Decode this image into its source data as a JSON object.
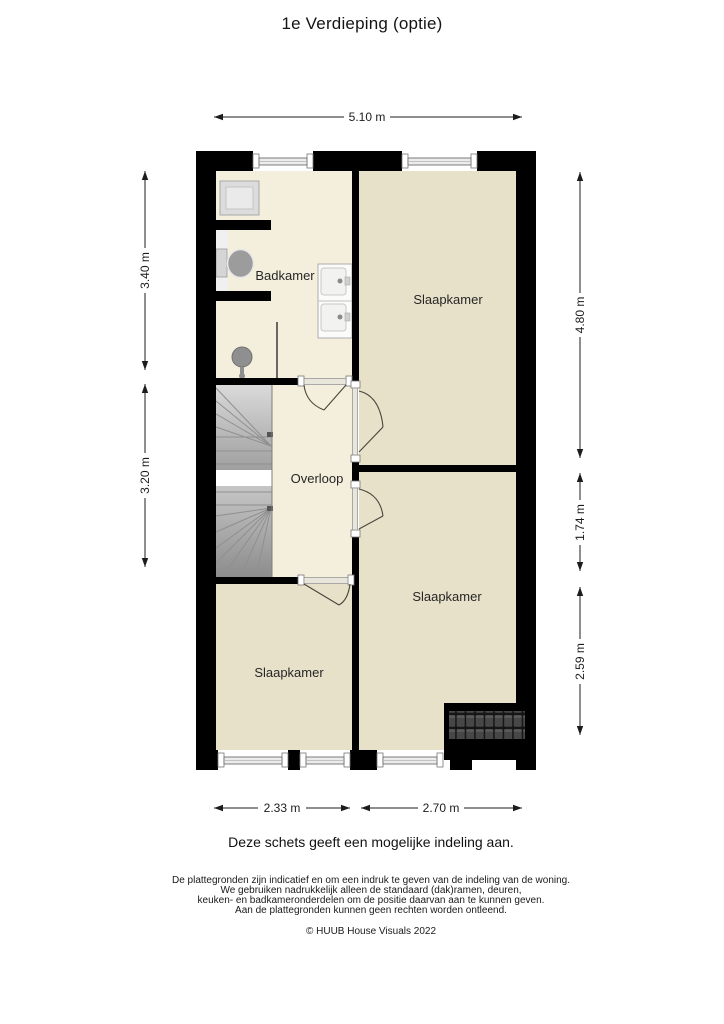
{
  "title": "1e Verdieping (optie)",
  "floorplan": {
    "labels": {
      "bathroom": "Badkamer",
      "bedroom_top_right": "Slaapkamer",
      "landing": "Overloop",
      "bedroom_mid_right": "Slaapkamer",
      "bedroom_bottom_left": "Slaapkamer"
    },
    "dimensions": {
      "top_width": "5.10 m",
      "left_upper": "3.40 m",
      "left_lower": "3.20 m",
      "right_upper": "4.80 m",
      "right_middle": "1.74 m",
      "right_lower": "2.59 m",
      "bottom_left": "2.33 m",
      "bottom_right": "2.70 m"
    },
    "colors": {
      "wall": "#000000",
      "floor_light": "#f4efdd",
      "floor_dark": "#e8e1c9",
      "roof_tile": "#474747",
      "stairs_light": "#d8d8d8",
      "stairs_dark": "#909090",
      "fixture_gray": "#9c9c9c"
    }
  },
  "caption": "Deze schets geeft een mogelijke indeling aan.",
  "disclaimer": {
    "line1": "De plattegronden zijn indicatief en om een indruk te geven van de indeling van de woning.",
    "line2": "We gebruiken nadrukkelijk alleen de standaard (dak)ramen, deuren,",
    "line3": "keuken- en badkameronderdelen om de positie daarvan aan te kunnen geven.",
    "line4": "Aan de plattegronden kunnen geen rechten worden ontleend."
  },
  "copyright": "© HUUB House Visuals 2022"
}
